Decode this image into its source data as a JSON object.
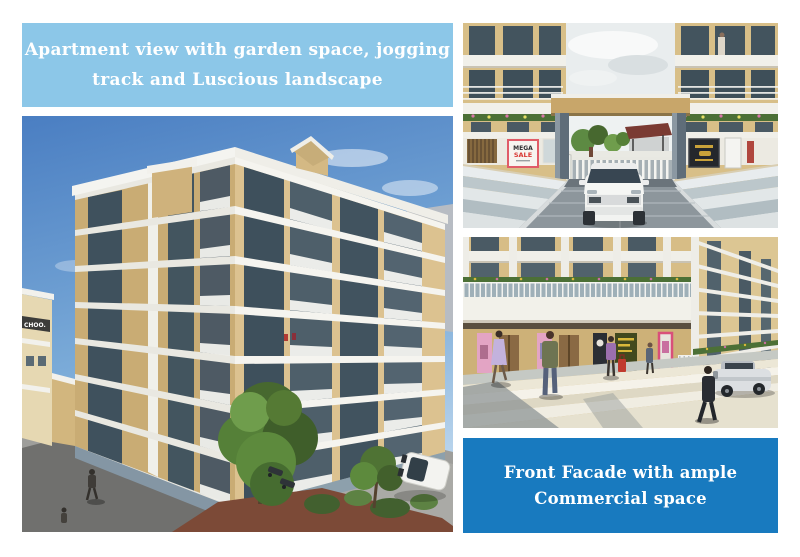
{
  "page": {
    "background": "#ffffff"
  },
  "captions": {
    "top": {
      "line1": "Apartment view with garden space, jogging",
      "line2": "track and Luscious landscape",
      "background": "#8cc7e8",
      "text_color": "#ffffff"
    },
    "bottom": {
      "line1": "Front Facade with ample",
      "line2": "Commercial space",
      "background": "#187abf",
      "text_color": "#ffffff"
    }
  },
  "panels": {
    "apartment_view": {
      "school_sign": "CHOO."
    },
    "entrance_view": {
      "sale_sign_line1": "MEGA",
      "sale_sign_line2": "SALE",
      "sale_sign_color": "#d93a35",
      "sale_frame_color": "#e05c68"
    },
    "facade_view": {}
  }
}
